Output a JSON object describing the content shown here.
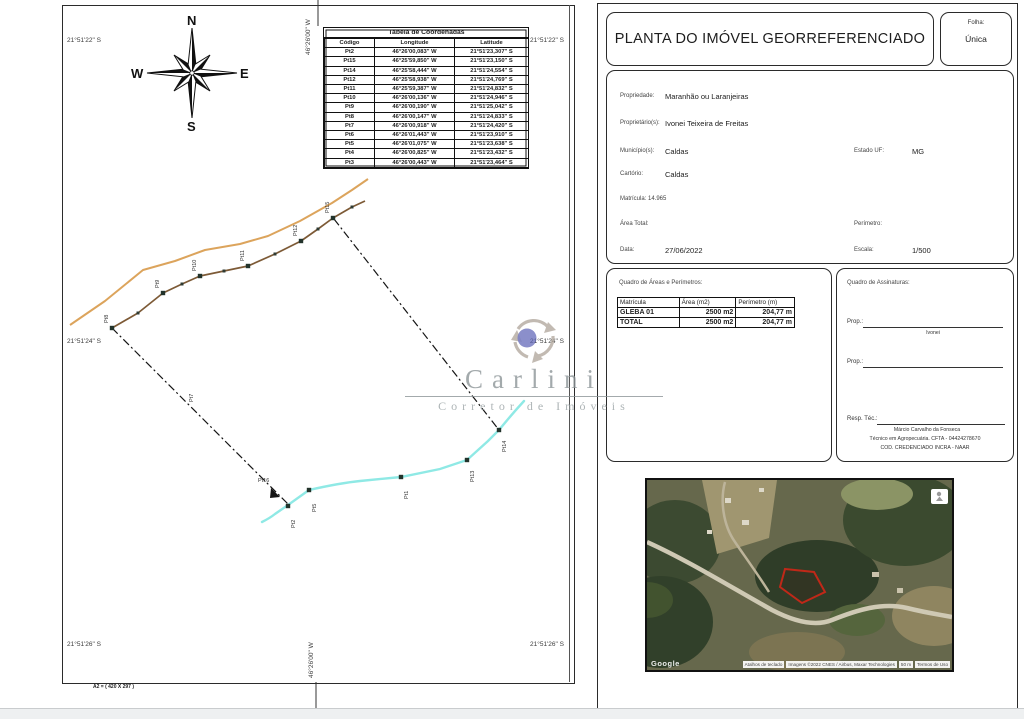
{
  "left_page": {
    "compass": {
      "n": "N",
      "s": "S",
      "e": "E",
      "w": "W"
    },
    "grid": {
      "lat_top": "21°51'22\" S",
      "lat_mid": "21°51'24\" S",
      "lat_bottom": "21°51'26\" S",
      "lon_top": "46°26'00\" W",
      "lon_bottom": "46°26'00\" W"
    },
    "format_note": "A2 = ( 420 X 297 )",
    "coord_table": {
      "title": "Tabela de Coordenadas",
      "headers": [
        "Código",
        "Longitude",
        "Latitude"
      ],
      "rows": [
        [
          "Pt2",
          "46°26'00,083\" W",
          "21°51'23,307\" S"
        ],
        [
          "Pt15",
          "46°25'59,850\" W",
          "21°51'23,150\" S"
        ],
        [
          "Pt14",
          "46°25'58,444\" W",
          "21°51'24,554\" S"
        ],
        [
          "Pt12",
          "46°25'58,938\" W",
          "21°51'24,769\" S"
        ],
        [
          "Pt11",
          "46°25'59,387\" W",
          "21°51'24,832\" S"
        ],
        [
          "Pt10",
          "46°26'00,136\" W",
          "21°51'24,946\" S"
        ],
        [
          "Pt9",
          "46°26'00,190\" W",
          "21°51'25,042\" S"
        ],
        [
          "Pt8",
          "46°26'00,147\" W",
          "21°51'24,833\" S"
        ],
        [
          "Pt7",
          "46°26'00,918\" W",
          "21°51'24,420\" S"
        ],
        [
          "Pt6",
          "46°26'01,443\" W",
          "21°51'23,910\" S"
        ],
        [
          "Pt5",
          "46°26'01,075\" W",
          "21°51'23,638\" S"
        ],
        [
          "Pt4",
          "46°26'00,825\" W",
          "21°51'23,432\" S"
        ],
        [
          "Pt3",
          "46°26'00,443\" W",
          "21°51'23,464\" S"
        ]
      ]
    },
    "map_points": [
      {
        "label": "Pt8",
        "x": 112,
        "y": 328,
        "rot": true
      },
      {
        "label": "Pt9",
        "x": 163,
        "y": 293,
        "rot": true
      },
      {
        "label": "Pt10",
        "x": 200,
        "y": 276,
        "rot": true
      },
      {
        "label": "Pt11",
        "x": 248,
        "y": 266,
        "rot": true
      },
      {
        "label": "Pt12",
        "x": 301,
        "y": 241,
        "rot": true
      },
      {
        "label": "Pt15",
        "x": 333,
        "y": 218,
        "rot": true
      },
      {
        "label": "Pt2",
        "x": 288,
        "y": 506,
        "rot": true,
        "below": true
      },
      {
        "label": "Pt5",
        "x": 309,
        "y": 490,
        "rot": true,
        "below": true
      },
      {
        "label": "Pt1",
        "x": 401,
        "y": 477,
        "rot": true,
        "below": true
      },
      {
        "label": "Pt13",
        "x": 467,
        "y": 460,
        "rot": true,
        "below": true
      },
      {
        "label": "Pt14",
        "x": 499,
        "y": 430,
        "rot": true,
        "below": true
      },
      {
        "label": "Pt7",
        "x": 197,
        "y": 407,
        "rot": true,
        "line_only": true
      },
      {
        "label": "Pt16",
        "x": 262,
        "y": 487,
        "rot": false,
        "line_only": true
      }
    ],
    "watermark": {
      "name": "Carlini",
      "subtitle": "Corretor de Imóveis"
    }
  },
  "right_page": {
    "title": "PLANTA DO IMÓVEL GEORREFERENCIADO",
    "folha_label": "Folha:",
    "folha_value": "Única",
    "info": {
      "propriedade_label": "Propriedade:",
      "propriedade": "Maranhão ou Laranjeiras",
      "proprietario_label": "Proprietário(s):",
      "proprietario": "Ivonei Teixeira de Freitas",
      "municipio_label": "Município(s):",
      "municipio": "Caldas",
      "estado_label": "Estado UF:",
      "estado": "MG",
      "cartorio_label": "Cartório:",
      "cartorio": "Caldas",
      "matricula_label": "Matrícula: 14.965",
      "area_total_label": "Área Total:",
      "perimetro_label": "Perímetro:",
      "data_label": "Data:",
      "data": "27/06/2022",
      "escala_label": "Escala:",
      "escala": "1/500"
    },
    "areas": {
      "title": "Quadro de Áreas e Perímetros:",
      "headers": [
        "Matrícula",
        "Área (m2)",
        "Perímetro (m)"
      ],
      "rows": [
        [
          "GLEBA 01",
          "2500 m2",
          "204,77 m"
        ],
        [
          "TOTAL",
          "2500 m2",
          "204,77 m"
        ]
      ]
    },
    "signatures": {
      "title": "Quadro de Assinaturas:",
      "prop1_label": "Prop.:",
      "prop1_name": "Ivonei",
      "prop2_label": "Prop.:",
      "resp_label": "Resp. Téc.:",
      "resp_name": "Márcio Carvalho da Fonseca",
      "resp_line2": "Técnico em Agropecuária. CFTA - 04424278670",
      "resp_line3": "COD. CREDENCIADO INCRA -    NAAR"
    }
  },
  "satellite": {
    "google": "Google",
    "attribution": [
      "Atalhos de teclado",
      "Imagens ©2022 CNES / Airbus, Maxar Technologies",
      "50 m",
      "Termos de Uso"
    ]
  }
}
